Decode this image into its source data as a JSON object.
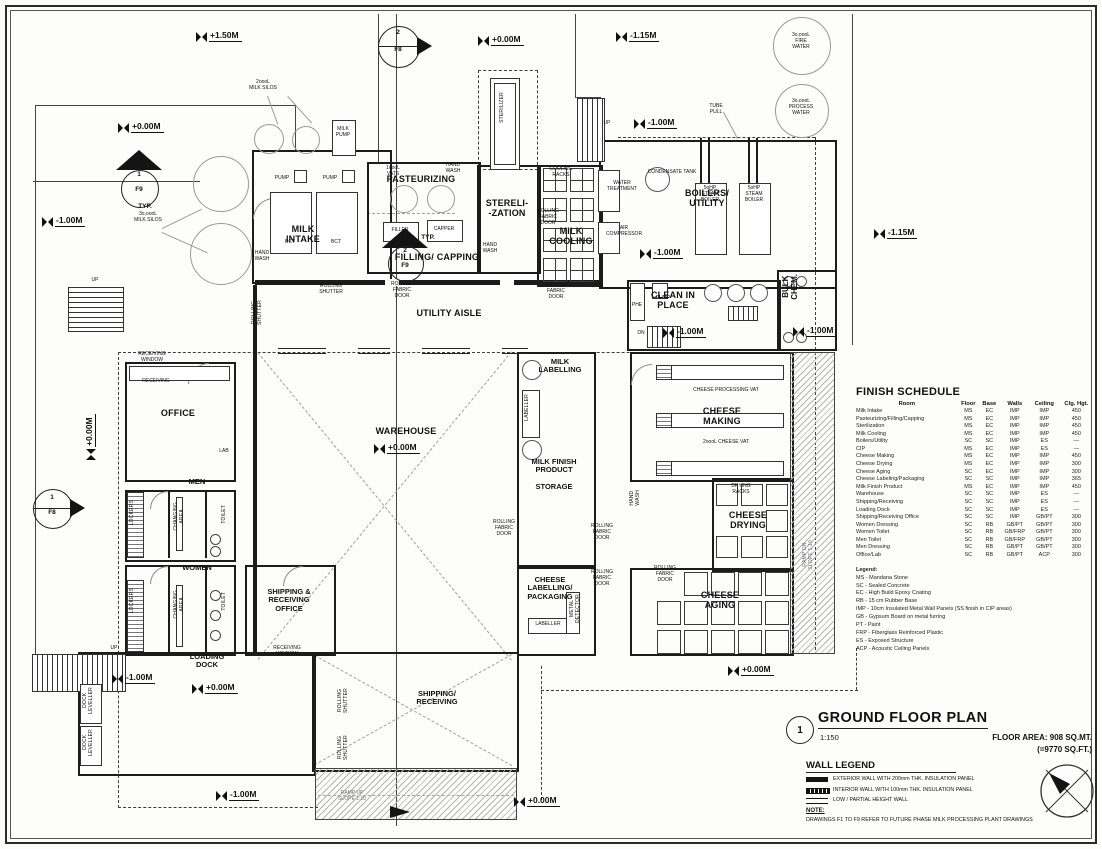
{
  "title_block": {
    "number": "1",
    "title": "GROUND FLOOR PLAN",
    "scale": "1:150",
    "floor_area_line1": "FLOOR AREA: 908 SQ.MT.",
    "floor_area_line2": "(=9770 SQ.FT.)"
  },
  "wall_legend": {
    "title": "WALL LEGEND",
    "items": [
      "EXTERIOR WALL WITH 200mm THK. INSULATION PANEL",
      "INTERIOR WALL WITH 100mm THK. INSULATION PANEL",
      "LOW / PARTIAL HEIGHT WALL"
    ]
  },
  "note": {
    "title": "NOTE:",
    "text": "DRAWINGS F1 TO F9 REFER TO FUTURE PHASE MILK PROCESSING PLANT DRAWINGS"
  },
  "finish_schedule": {
    "title": "FINISH SCHEDULE",
    "columns": [
      "Room",
      "Floor",
      "Base",
      "Walls",
      "Ceiling",
      "Clg. Hgt."
    ],
    "rows": [
      [
        "Milk Intake",
        "MS",
        "EC",
        "IMP",
        "IMP",
        "450"
      ],
      [
        "Pasteurizing/Filling/Capping",
        "MS",
        "EC",
        "IMP",
        "IMP",
        "450"
      ],
      [
        "Sterilization",
        "MS",
        "EC",
        "IMP",
        "IMP",
        "450"
      ],
      [
        "Milk Cooling",
        "MS",
        "EC",
        "IMP",
        "IMP",
        "450"
      ],
      [
        "Boilers/Utility",
        "SC",
        "SC",
        "IMP",
        "ES",
        "—"
      ],
      [
        "CIP",
        "MS",
        "EC",
        "IMP",
        "ES",
        "—"
      ],
      [
        "Cheese Making",
        "MS",
        "EC",
        "IMP",
        "IMP",
        "450"
      ],
      [
        "Cheese Drying",
        "MS",
        "EC",
        "IMP",
        "IMP",
        "300"
      ],
      [
        "Cheese Aging",
        "SC",
        "EC",
        "IMP",
        "IMP",
        "300"
      ],
      [
        "Cheese Labeling/Packaging",
        "SC",
        "SC",
        "IMP",
        "IMP",
        "365"
      ],
      [
        "Milk Finish Product",
        "MS",
        "EC",
        "IMP",
        "IMP",
        "450"
      ],
      [
        "Warehouse",
        "SC",
        "SC",
        "IMP",
        "ES",
        "—"
      ],
      [
        "Shipping/Receiving",
        "SC",
        "SC",
        "IMP",
        "ES",
        "—"
      ],
      [
        "Loading Dock",
        "SC",
        "SC",
        "IMP",
        "ES",
        "—"
      ],
      [
        "Shipping/Receiving Office",
        "SC",
        "SC",
        "IMP",
        "GB/PT",
        "300"
      ],
      [
        "Women Dressing",
        "SC",
        "RB",
        "GB/PT",
        "GB/PT",
        "300"
      ],
      [
        "Women Toilet",
        "SC",
        "RB",
        "GB/FRP",
        "GB/PT",
        "300"
      ],
      [
        "Men Toilet",
        "SC",
        "RB",
        "GB/FRP",
        "GB/PT",
        "300"
      ],
      [
        "Men Dressing",
        "SC",
        "RB",
        "GB/PT",
        "GB/PT",
        "300"
      ],
      [
        "Office/Lab",
        "SC",
        "RB",
        "GB/PT",
        "ACP",
        "300"
      ]
    ],
    "legend_title": "Legend:",
    "legend": [
      "MS - Mandana Stone",
      "SC - Sealed Concrete",
      "EC - High Build Epoxy Coating",
      "RB - 15 cm Rubber Base",
      "IMP - 10cm Insulated Metal Wall Panels (SS finish in CIP areas)",
      "GB - Gypsum Board on metal furring",
      "PT - Paint",
      "FRP - Fiberglass Reinforced Plastic",
      "ES - Exposed Structure",
      "ACP - Acoustic Ceiling Panels"
    ]
  },
  "levels": [
    {
      "t": "+1.50M",
      "x": 196,
      "y": 30
    },
    {
      "t": "+0.00M",
      "x": 478,
      "y": 34
    },
    {
      "t": "-1.15M",
      "x": 616,
      "y": 30
    },
    {
      "t": "+0.00M",
      "x": 118,
      "y": 121
    },
    {
      "t": "-1.00M",
      "x": 634,
      "y": 117
    },
    {
      "t": "-1.00M",
      "x": 42,
      "y": 215
    },
    {
      "t": "-1.15M",
      "x": 874,
      "y": 227
    },
    {
      "t": "-1.00M",
      "x": 640,
      "y": 247
    },
    {
      "t": "-1.00M",
      "x": 663,
      "y": 326
    },
    {
      "t": "-1.00M",
      "x": 793,
      "y": 325
    },
    {
      "t": "+0.00M",
      "x": 374,
      "y": 442
    },
    {
      "t": "+0.00M",
      "x": 84,
      "y": 460,
      "rot": true
    },
    {
      "t": "-1.00M",
      "x": 112,
      "y": 672
    },
    {
      "t": "+0.00M",
      "x": 192,
      "y": 682
    },
    {
      "t": "+0.00M",
      "x": 728,
      "y": 664
    },
    {
      "t": "-1.00M",
      "x": 216,
      "y": 789
    },
    {
      "t": "+0.00M",
      "x": 514,
      "y": 795
    }
  ],
  "labels": [
    {
      "n": "room-label-milk-intake",
      "t": "MILK\nINTAKE",
      "x": 303,
      "y": 224,
      "c": "r"
    },
    {
      "n": "room-label-pasteurizing",
      "t": "PASTEURIZING",
      "x": 421,
      "y": 174,
      "c": "r"
    },
    {
      "n": "room-label-sterilization",
      "t": "STERELI-\n-ZATION",
      "x": 507,
      "y": 198,
      "c": "r"
    },
    {
      "n": "room-label-filling-capping",
      "t": "FILLING/ CAPPING",
      "x": 437,
      "y": 252,
      "c": "r"
    },
    {
      "n": "room-label-milk-cooling",
      "t": "MILK\nCOOLING",
      "x": 571,
      "y": 226,
      "c": "r"
    },
    {
      "n": "room-label-boilers-utility",
      "t": "BOILERS/\nUTILITY",
      "x": 707,
      "y": 188,
      "c": "r"
    },
    {
      "n": "room-label-utility-aisle",
      "t": "UTILITY AISLE",
      "x": 449,
      "y": 308,
      "c": "r"
    },
    {
      "n": "room-label-clean-in-place",
      "t": "CLEAN IN\nPLACE",
      "x": 673,
      "y": 290,
      "c": "r"
    },
    {
      "n": "room-label-bulk-chem",
      "t": "BULK\nCHEM.",
      "x": 781,
      "y": 274,
      "c": "rv"
    },
    {
      "n": "room-label-office",
      "t": "OFFICE",
      "x": 178,
      "y": 408,
      "c": "r"
    },
    {
      "n": "room-label-men",
      "t": "MEN",
      "x": 197,
      "y": 478,
      "c": "r8"
    },
    {
      "n": "room-label-women",
      "t": "WOMEN",
      "x": 197,
      "y": 564,
      "c": "r8"
    },
    {
      "n": "room-label-shipping-receiving-office",
      "t": "SHIPPING &\nRECEIVING\nOFFICE",
      "x": 289,
      "y": 588,
      "c": "r8"
    },
    {
      "n": "room-label-warehouse",
      "t": "WAREHOUSE",
      "x": 406,
      "y": 426,
      "c": "r"
    },
    {
      "n": "room-label-milk-labelling",
      "t": "MILK\nLABELLING",
      "x": 560,
      "y": 358,
      "c": "r8"
    },
    {
      "n": "room-label-milk-finish-product",
      "t": "MILK FINISH\nPRODUCT\n\nSTORAGE",
      "x": 554,
      "y": 458,
      "c": "r8"
    },
    {
      "n": "room-label-cheese-labelling",
      "t": "CHEESE\nLABELLING/\nPACKAGING",
      "x": 550,
      "y": 576,
      "c": "r8"
    },
    {
      "n": "room-label-cheese-making",
      "t": "CHEESE\nMAKING",
      "x": 722,
      "y": 406,
      "c": "r"
    },
    {
      "n": "room-label-cheese-drying",
      "t": "CHEESE\nDRYING",
      "x": 748,
      "y": 510,
      "c": "r"
    },
    {
      "n": "room-label-cheese-aging",
      "t": "CHEESE\nAGING",
      "x": 720,
      "y": 590,
      "c": "r"
    },
    {
      "n": "room-label-loading-dock",
      "t": "LOADING\nDOCK",
      "x": 207,
      "y": 653,
      "c": "r8"
    },
    {
      "n": "room-label-shipping-receiving",
      "t": "SHIPPING/\nRECEIVING",
      "x": 437,
      "y": 690,
      "c": "r8"
    },
    {
      "n": "label-milk-silos-2000",
      "t": "2oooL\nMILK SILOS",
      "x": 263,
      "y": 80,
      "c": "t"
    },
    {
      "n": "label-milk-silos-30000",
      "t": "3o,oooL\nMILK SILOS",
      "x": 148,
      "y": 212,
      "c": "t"
    },
    {
      "n": "label-fire-water",
      "t": "3o,oooL\nFIRE\nWATER",
      "x": 801,
      "y": 33,
      "c": "t"
    },
    {
      "n": "label-process-water",
      "t": "3o,oooL\nPROCESS\nWATER",
      "x": 801,
      "y": 99,
      "c": "t"
    },
    {
      "n": "label-milk-pump",
      "t": "MILK\nPUMP",
      "x": 343,
      "y": 127,
      "c": "t"
    },
    {
      "n": "label-pump-1",
      "t": "PUMP",
      "x": 282,
      "y": 176,
      "c": "t"
    },
    {
      "n": "label-pump-2",
      "t": "PUMP",
      "x": 330,
      "y": 176,
      "c": "t"
    },
    {
      "n": "label-bct-1",
      "t": "BCT",
      "x": 290,
      "y": 240,
      "c": "t"
    },
    {
      "n": "label-bct-2",
      "t": "BCT",
      "x": 336,
      "y": 240,
      "c": "t"
    },
    {
      "n": "label-vats-1000",
      "t": "1oooL\nVATS",
      "x": 393,
      "y": 166,
      "c": "t"
    },
    {
      "n": "label-hand-wash-1",
      "t": "HAND\nWASH",
      "x": 453,
      "y": 163,
      "c": "t"
    },
    {
      "n": "label-hand-wash-2",
      "t": "HAND\nWASH",
      "x": 262,
      "y": 251,
      "c": "t"
    },
    {
      "n": "label-hand-wash-3",
      "t": "HAND\nWASH",
      "x": 490,
      "y": 243,
      "c": "t"
    },
    {
      "n": "label-filler",
      "t": "FILLER",
      "x": 400,
      "y": 228,
      "c": "t"
    },
    {
      "n": "label-capper",
      "t": "CAPPER",
      "x": 444,
      "y": 227,
      "c": "t"
    },
    {
      "n": "label-typ-1",
      "t": "TYP.",
      "x": 428,
      "y": 234,
      "c": "s"
    },
    {
      "n": "label-typ-2",
      "t": "TYP.",
      "x": 145,
      "y": 203,
      "c": "s"
    },
    {
      "n": "label-sterilizer",
      "t": "STERILIZER",
      "x": 500,
      "y": 92,
      "c": "v"
    },
    {
      "n": "label-cooling-racks",
      "t": "COOLING\nRACKS",
      "x": 561,
      "y": 167,
      "c": "t"
    },
    {
      "n": "label-water-treatment",
      "t": "WATER\nTREATMENT",
      "x": 622,
      "y": 181,
      "c": "t"
    },
    {
      "n": "label-air-compressor",
      "t": "AIR\nCOMPRESSOR",
      "x": 624,
      "y": 226,
      "c": "t"
    },
    {
      "n": "label-condensate-tank",
      "t": "CONDENSATE TANK",
      "x": 672,
      "y": 170,
      "c": "t"
    },
    {
      "n": "label-steam-boiler-1",
      "t": "5oHP\nSTEAM\nBOILER",
      "x": 710,
      "y": 186,
      "c": "t"
    },
    {
      "n": "label-steam-boiler-2",
      "t": "5oHP\nSTEAM\nBOILER",
      "x": 754,
      "y": 186,
      "c": "t"
    },
    {
      "n": "label-tube-pull",
      "t": "TUBE\nPULL",
      "x": 716,
      "y": 104,
      "c": "t"
    },
    {
      "n": "label-phe",
      "t": "PHE",
      "x": 637,
      "y": 303,
      "c": "t"
    },
    {
      "n": "label-pump-cip",
      "t": "PUMP",
      "x": 663,
      "y": 296,
      "c": "t"
    },
    {
      "n": "label-dn-cip",
      "t": "DN",
      "x": 641,
      "y": 331,
      "c": "t"
    },
    {
      "n": "label-up-1",
      "t": "UP",
      "x": 607,
      "y": 121,
      "c": "t"
    },
    {
      "n": "label-up-2",
      "t": "UP",
      "x": 95,
      "y": 278,
      "c": "t"
    },
    {
      "n": "label-up-3",
      "t": "UP",
      "x": 114,
      "y": 646,
      "c": "t"
    },
    {
      "n": "label-rolling-shutter-1",
      "t": "ROLLING\nSHUTTER",
      "x": 331,
      "y": 284,
      "c": "t"
    },
    {
      "n": "label-rolling-fabric-door-1",
      "t": "ROLLING\nFABRIC\nDOOR",
      "x": 402,
      "y": 282,
      "c": "t"
    },
    {
      "n": "label-rolling-shutter-v1",
      "t": "ROLLING\nSHUTTER",
      "x": 252,
      "y": 300,
      "c": "v"
    },
    {
      "n": "label-rolling-fabric-door-2",
      "t": "ROLLING\nFABRIC\nDOOR",
      "x": 548,
      "y": 209,
      "c": "t"
    },
    {
      "n": "label-rolling-fabric-door-3",
      "t": "ROLLING\nFABRIC\nDOOR",
      "x": 556,
      "y": 283,
      "c": "t"
    },
    {
      "n": "label-rolling-fabric-door-4",
      "t": "ROLLING\nFABRIC\nDOOR",
      "x": 504,
      "y": 520,
      "c": "t"
    },
    {
      "n": "label-rolling-fabric-door-5",
      "t": "ROLLING\nFABRIC\nDOOR",
      "x": 602,
      "y": 524,
      "c": "t"
    },
    {
      "n": "label-rolling-fabric-door-6",
      "t": "ROLLING\nFABRIC\nDOOR",
      "x": 602,
      "y": 570,
      "c": "t"
    },
    {
      "n": "label-rolling-fabric-door-7",
      "t": "ROLLING\nFABRIC\nDOOR",
      "x": 665,
      "y": 566,
      "c": "t"
    },
    {
      "n": "label-rolling-shutter-v2",
      "t": "ROLLING\nSHUTTER",
      "x": 338,
      "y": 688,
      "c": "v"
    },
    {
      "n": "label-rolling-shutter-v3",
      "t": "ROLLING\nSHUTTER",
      "x": 338,
      "y": 735,
      "c": "v"
    },
    {
      "n": "label-dock-leveller-1",
      "t": "DOCK\nLEVELLER",
      "x": 83,
      "y": 687,
      "c": "v"
    },
    {
      "n": "label-dock-leveller-2",
      "t": "DOCK\nLEVELLER",
      "x": 83,
      "y": 729,
      "c": "v"
    },
    {
      "n": "label-receiving-window-1",
      "t": "RECEIVING\nWINDOW",
      "x": 152,
      "y": 352,
      "c": "t"
    },
    {
      "n": "label-receiving",
      "t": "RECEIVING",
      "x": 156,
      "y": 379,
      "c": "t"
    },
    {
      "n": "label-lab",
      "t": "LAB",
      "x": 224,
      "y": 449,
      "c": "t"
    },
    {
      "n": "label-receiving-window-2",
      "t": "RECEIVING\nWINDOW",
      "x": 287,
      "y": 646,
      "c": "t"
    },
    {
      "n": "label-lockers-men",
      "t": "LOCKERS",
      "x": 130,
      "y": 500,
      "c": "v"
    },
    {
      "n": "label-lockers-women",
      "t": "LOCKERS",
      "x": 130,
      "y": 588,
      "c": "v"
    },
    {
      "n": "label-changing-area-men",
      "t": "CHANGING\nAREA",
      "x": 174,
      "y": 502,
      "c": "v"
    },
    {
      "n": "label-changing-area-women",
      "t": "CHANGING\nAREA",
      "x": 174,
      "y": 590,
      "c": "v"
    },
    {
      "n": "label-toilet-men",
      "t": "TOILET",
      "x": 222,
      "y": 505,
      "c": "v"
    },
    {
      "n": "label-toilet-women",
      "t": "TOILET",
      "x": 222,
      "y": 592,
      "c": "v"
    },
    {
      "n": "label-hand-wash-4",
      "t": "HAND\nWASH",
      "x": 630,
      "y": 490,
      "c": "v"
    },
    {
      "n": "label-cheese-processing-vat",
      "t": "CHEESE PROCESSING VAT",
      "x": 726,
      "y": 388,
      "c": "t"
    },
    {
      "n": "label-cheese-vat-2000",
      "t": "2oooL CHEESE VAT",
      "x": 726,
      "y": 440,
      "c": "t"
    },
    {
      "n": "label-drying-racks",
      "t": "DRYING\nRACKS",
      "x": 741,
      "y": 484,
      "c": "t"
    },
    {
      "n": "label-labeller-milk",
      "t": "LABELLER",
      "x": 525,
      "y": 394,
      "c": "v"
    },
    {
      "n": "label-labeller-cheese",
      "t": "LABELLER",
      "x": 548,
      "y": 622,
      "c": "t"
    },
    {
      "n": "label-metal-detector",
      "t": "METAL\nDETECTOR",
      "x": 570,
      "y": 594,
      "c": "v"
    },
    {
      "n": "label-ramp-dn",
      "t": "RAMP DN\nSLOPE 1:10",
      "x": 803,
      "y": 540,
      "c": "v g"
    },
    {
      "n": "label-ramp-up",
      "t": "RAMP UP\nSLOPE 1:10",
      "x": 352,
      "y": 791,
      "c": "t g"
    },
    {
      "n": "section-marker-2f8-num",
      "t": "2",
      "x": 398,
      "y": 29,
      "c": "s"
    },
    {
      "n": "section-marker-2f8-sheet",
      "t": "F8",
      "x": 398,
      "y": 46,
      "c": "s"
    },
    {
      "n": "section-marker-1f9-num",
      "t": "1",
      "x": 139,
      "y": 171,
      "c": "s"
    },
    {
      "n": "section-marker-1f9-sheet",
      "t": "F9",
      "x": 139,
      "y": 186,
      "c": "s"
    },
    {
      "n": "section-marker-2f9-num",
      "t": "2",
      "x": 405,
      "y": 247,
      "c": "s"
    },
    {
      "n": "section-marker-2f9-sheet",
      "t": "F9",
      "x": 405,
      "y": 262,
      "c": "s"
    },
    {
      "n": "section-marker-1f8-num",
      "t": "1",
      "x": 52,
      "y": 494,
      "c": "s"
    },
    {
      "n": "section-marker-1f8-sheet",
      "t": "F8",
      "x": 52,
      "y": 509,
      "c": "s"
    }
  ]
}
